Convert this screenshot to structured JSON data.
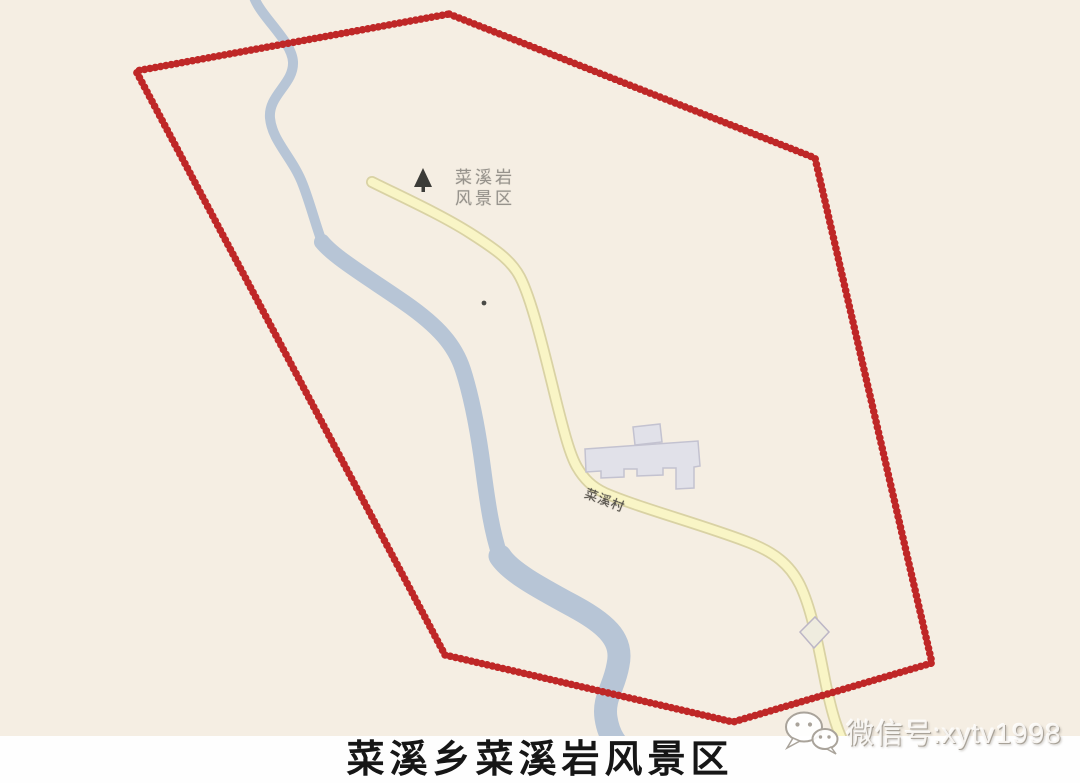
{
  "page": {
    "type": "map-figure",
    "caption": "菜溪乡菜溪岩风景区"
  },
  "map": {
    "scenic_label": {
      "line1": "菜溪岩",
      "line2": "风景区"
    },
    "road_label": "菜溪村",
    "features": {
      "boundary": "red dotted polygon around scenic area",
      "river": "light blue stream winding top to bottom",
      "road": "pale yellow road winding from scenic point to bottom right",
      "buildings": "gray building footprints near road"
    },
    "icons": {
      "tree": "tree-icon",
      "poi": "poi-dot-icon"
    }
  },
  "watermark": {
    "icon": "wechat-icon",
    "text": "微信号:xytv1998"
  },
  "colors": {
    "map_background": "#f5eee3",
    "boundary_red": "#bf2727",
    "river_blue": "#b7c5d6",
    "road_fill": "#f9f5c6",
    "road_casing": "#d9d2a4",
    "building_fill": "#e1e1e9",
    "building_stroke": "#c3c2d0",
    "caption_band": "#fefefe",
    "caption_text": "#161616",
    "scenic_label_gray": "#97938c",
    "road_label_gray": "#55514a",
    "tree_icon_dark": "#3c3c38"
  }
}
